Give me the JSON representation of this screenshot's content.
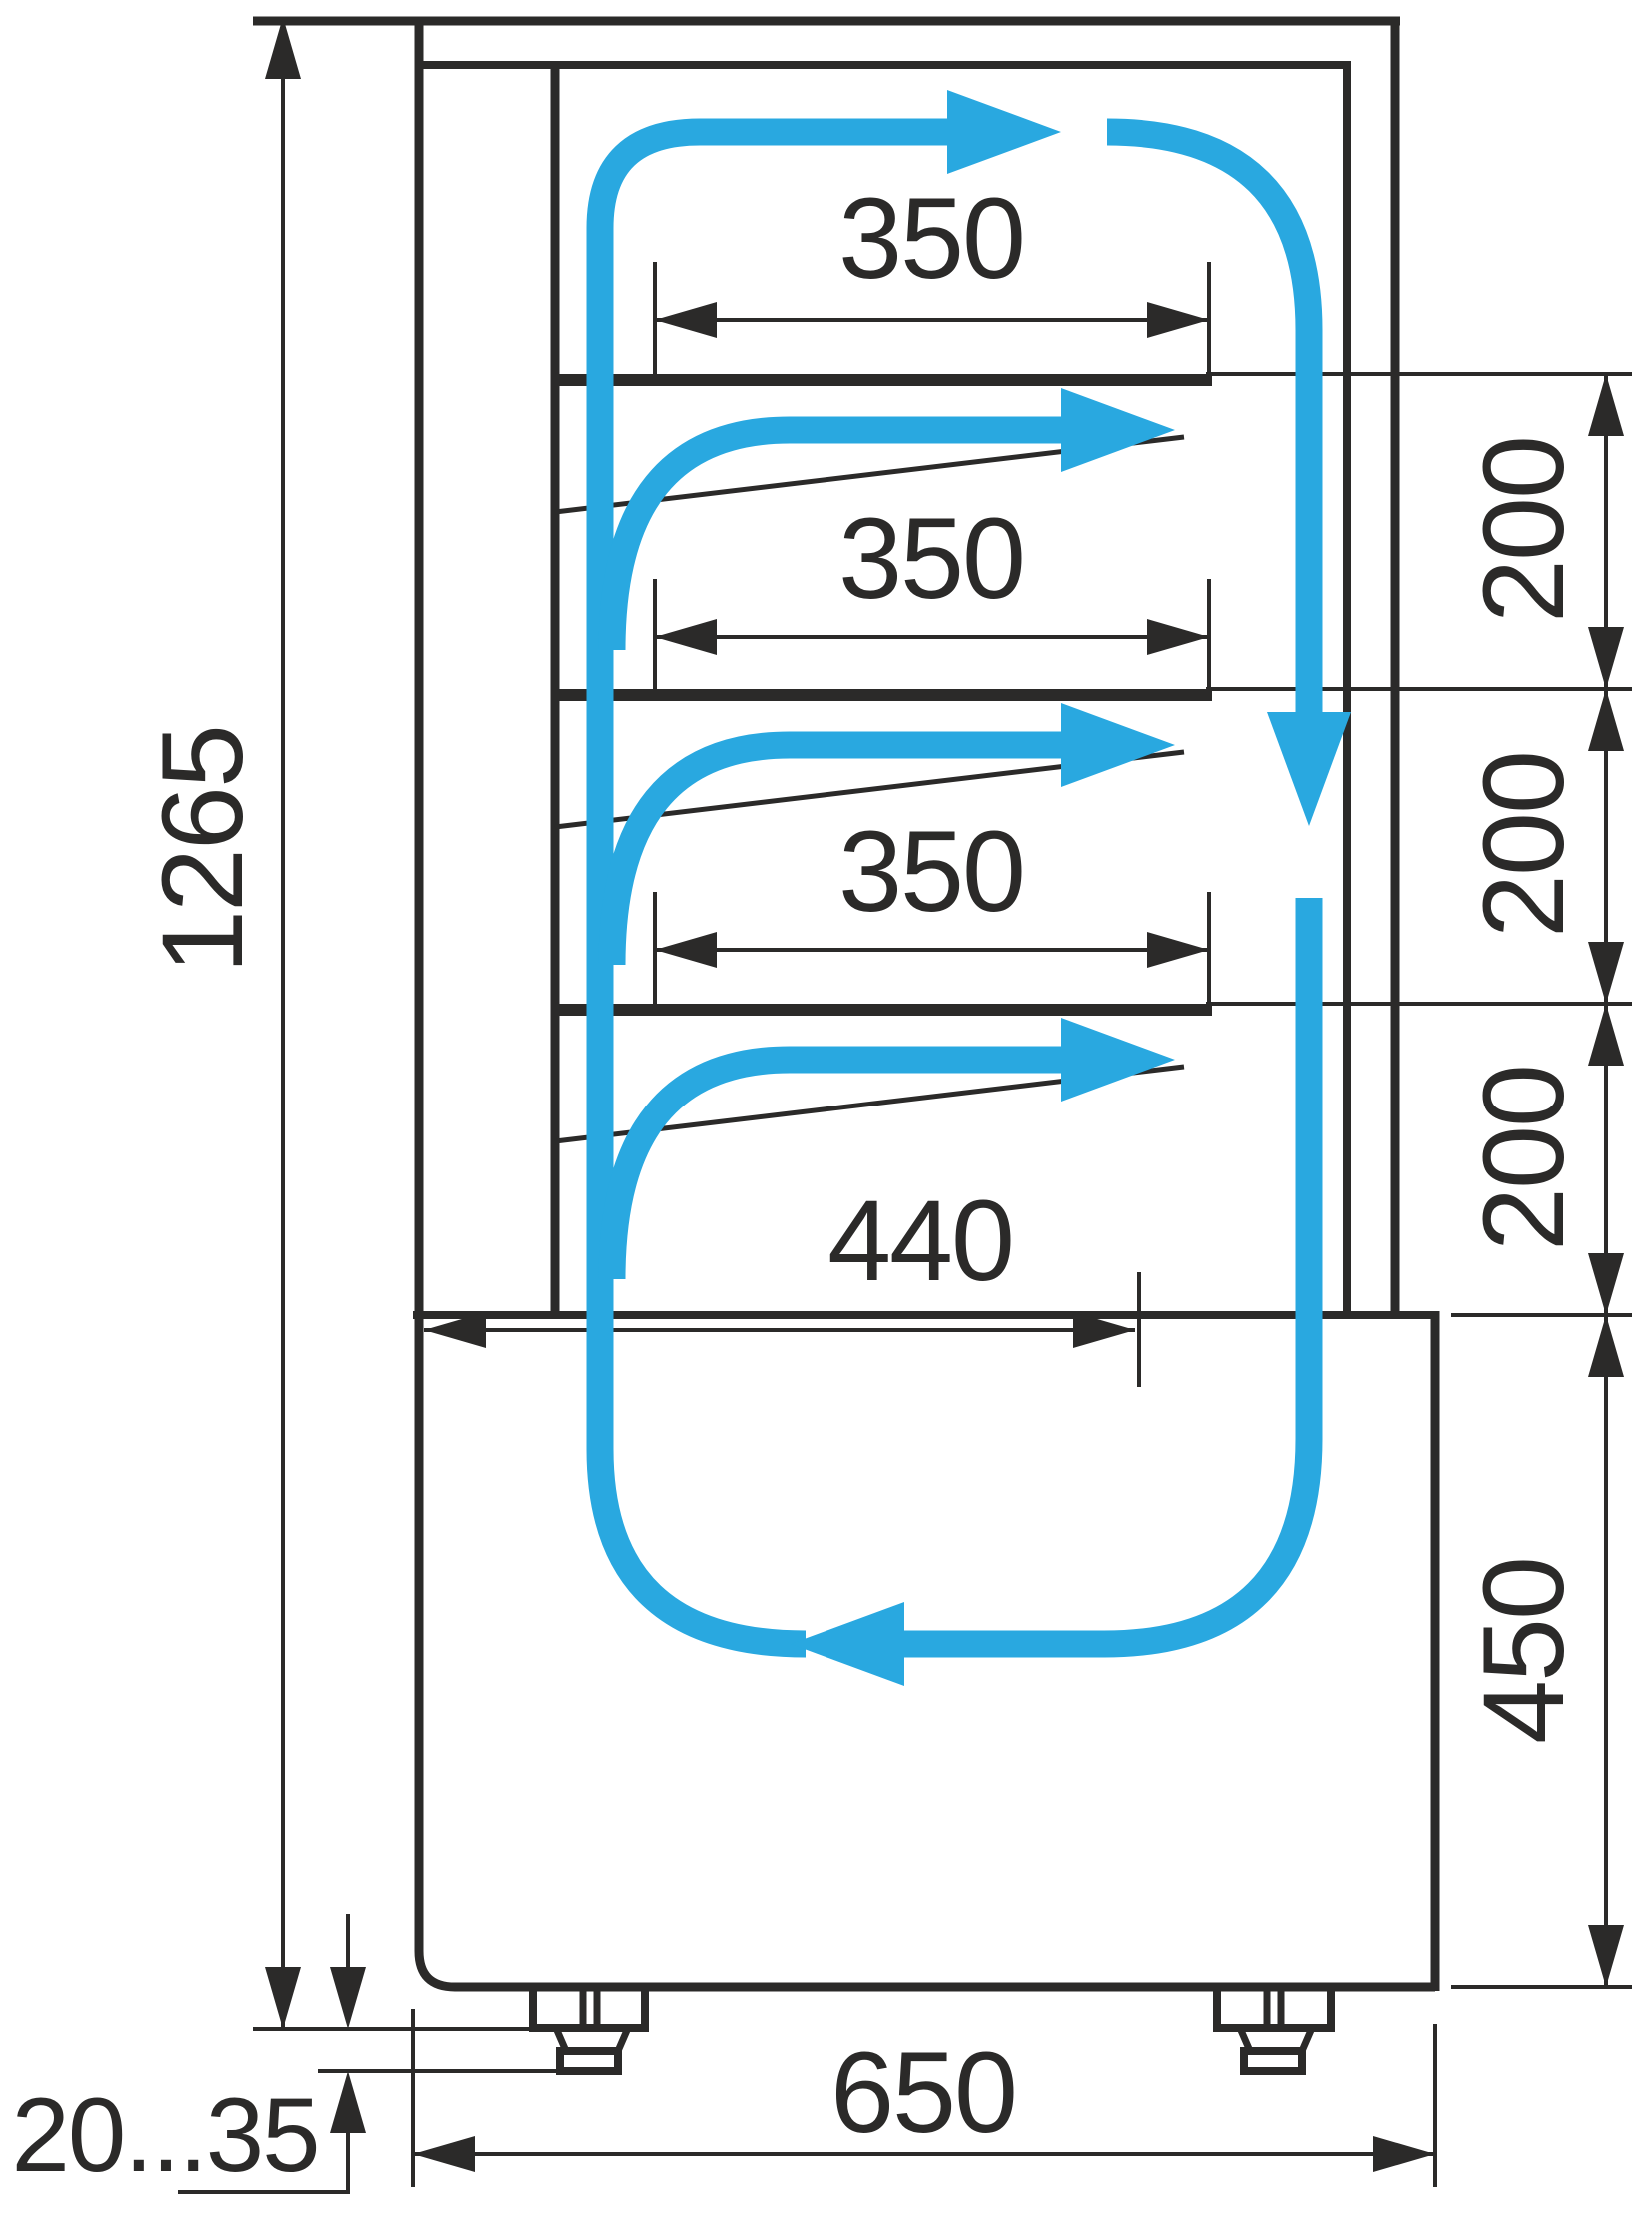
{
  "diagram": {
    "type": "technical-drawing",
    "subject": "refrigerated-display-case-cross-section-with-airflow",
    "colors": {
      "line": "#2b2a29",
      "airflow": "#29a8e0",
      "background": "#ffffff"
    },
    "dimensions": {
      "shelf_widths": [
        "350",
        "350",
        "350"
      ],
      "deck_width": "440",
      "total_height": "1265",
      "shelf_gaps": [
        "200",
        "200",
        "200"
      ],
      "base_height": "450",
      "depth": "650",
      "feet_adjust_range": "20...35"
    }
  }
}
